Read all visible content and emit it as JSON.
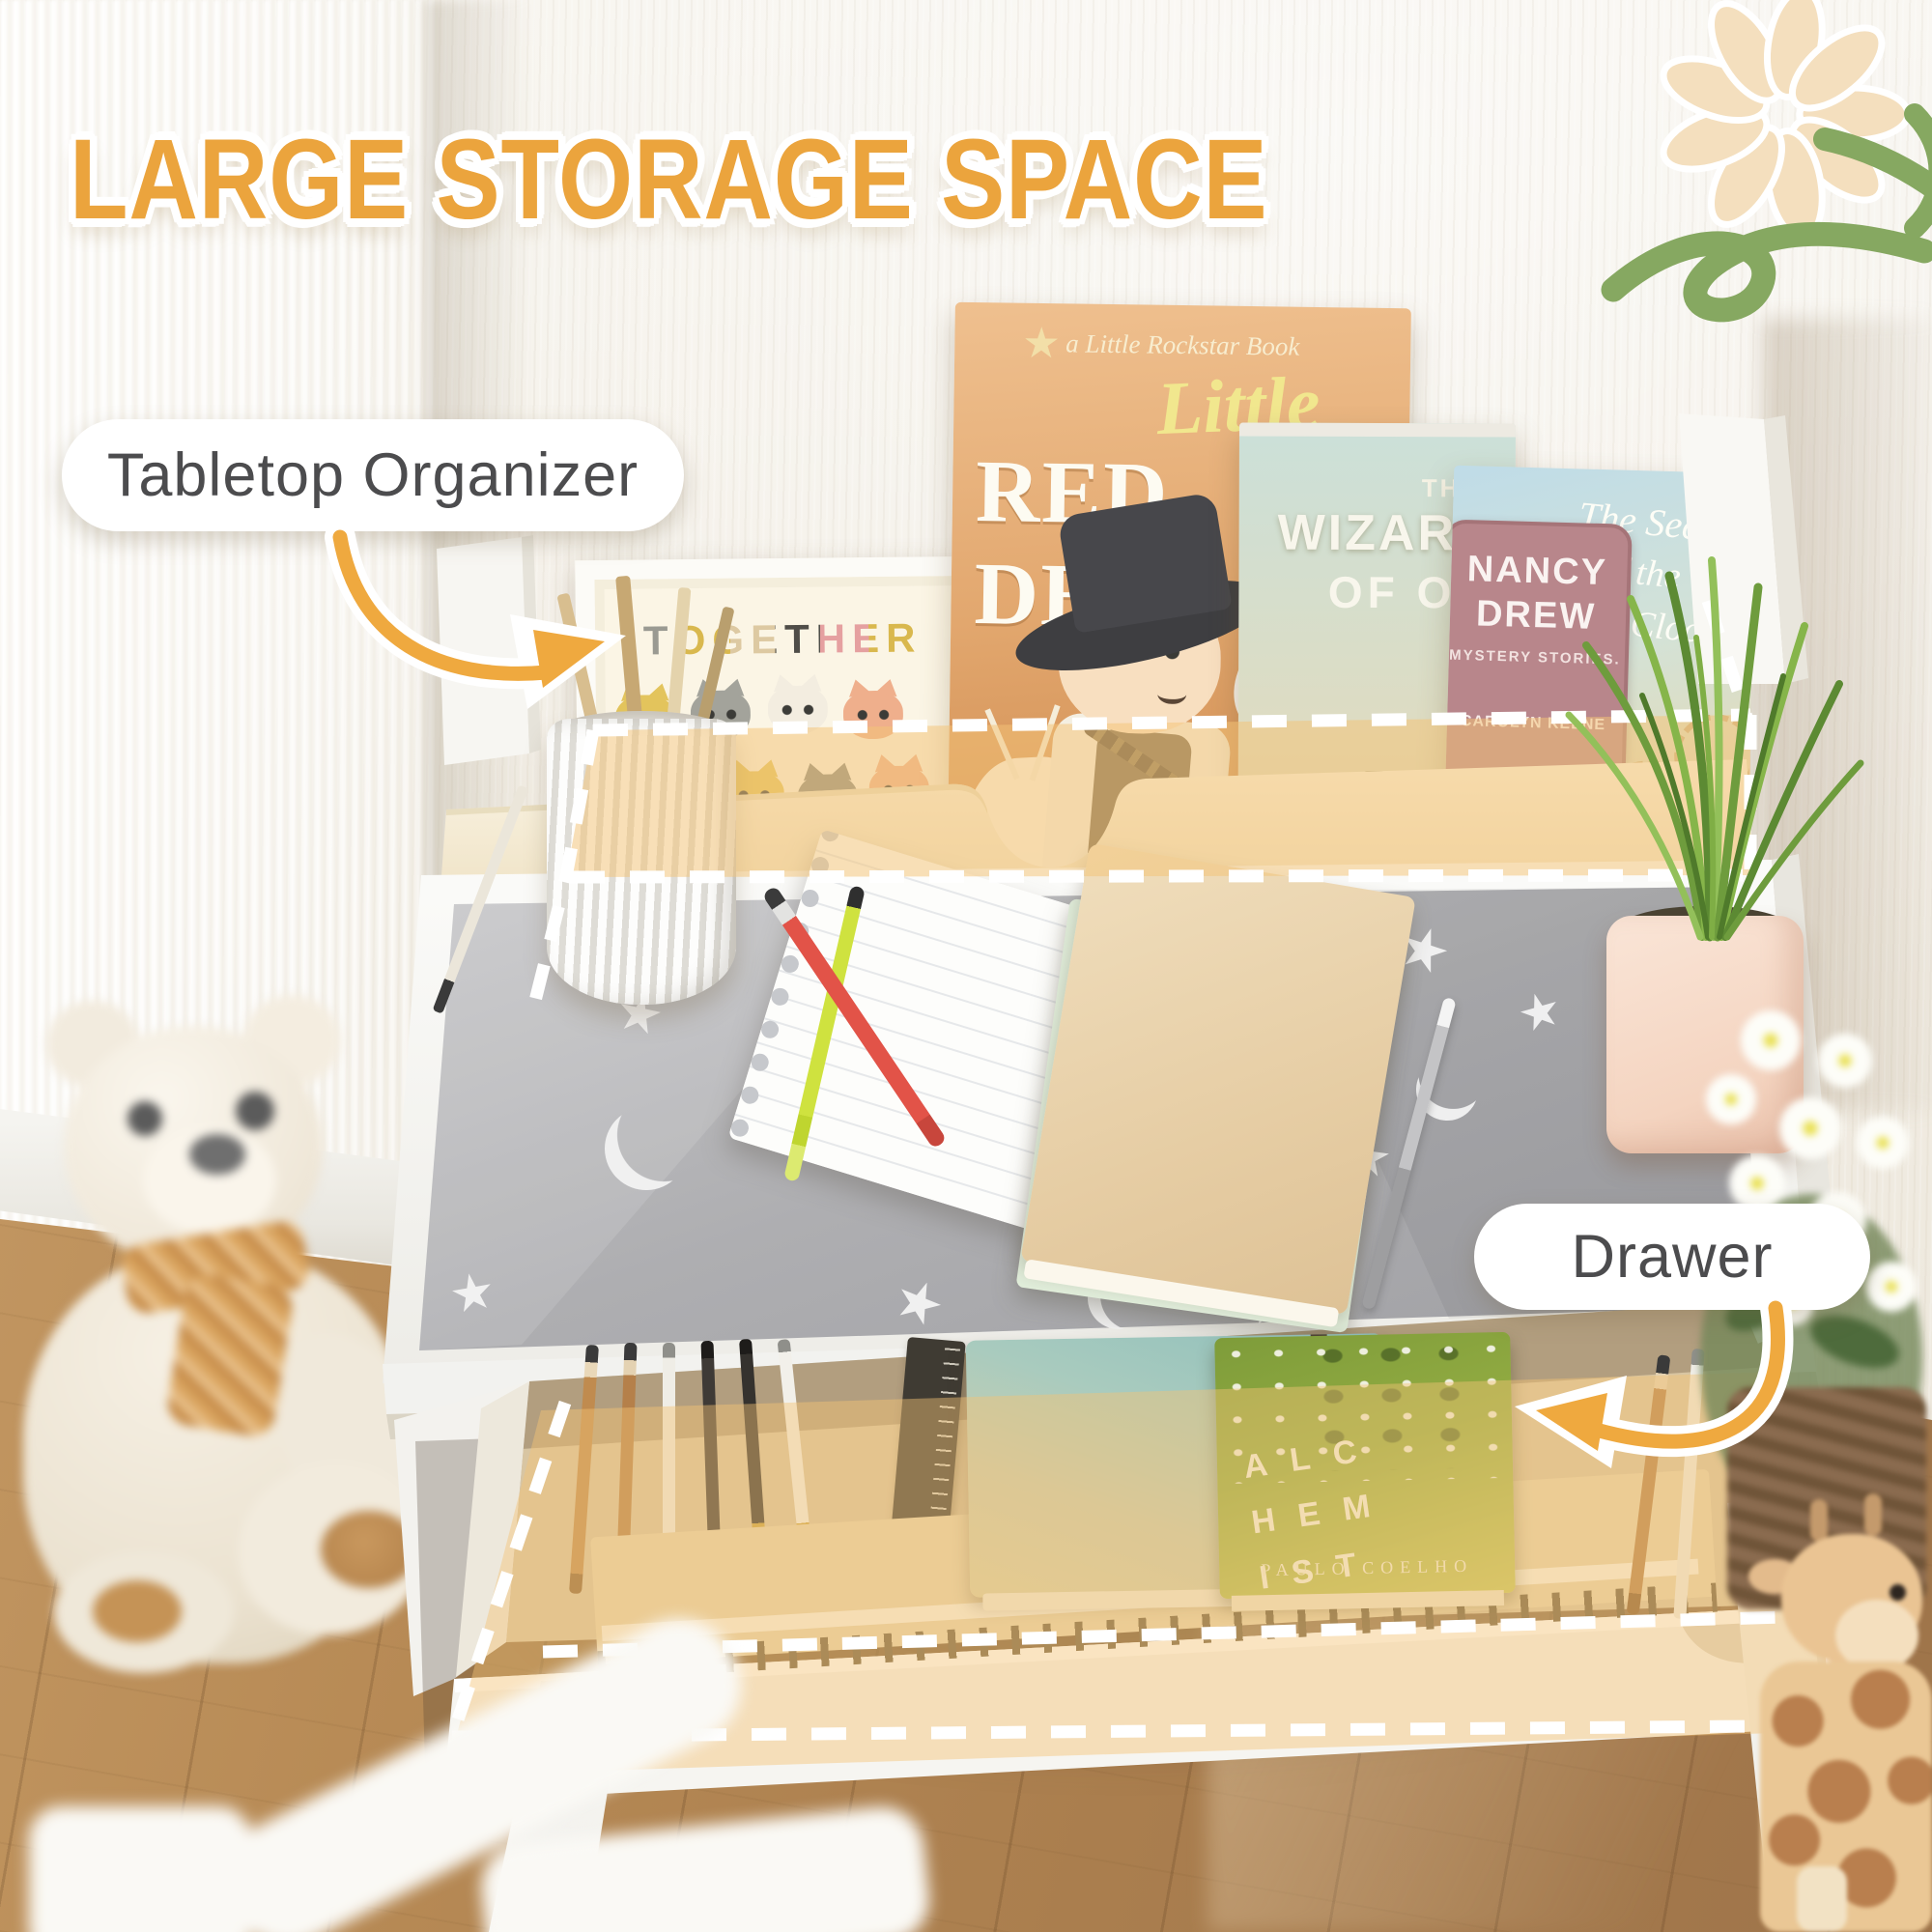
{
  "headline": "LARGE STORAGE SPACE",
  "callouts": {
    "organizer": "Tabletop Organizer",
    "drawer": "Drawer"
  },
  "books": {
    "cat_print": {
      "title": "TOGETHER"
    },
    "red_dead": {
      "imprint": "a Little Rockstar Book",
      "script": "Little",
      "title": "RED DEAD"
    },
    "wizard_oz": {
      "pre": "THE",
      "title": "WIZARD",
      "post": "OF OZ"
    },
    "nancy_drew": {
      "series_top": "NANCY",
      "series_bottom": "DREW",
      "subtitle": "MYSTERY STORIES.",
      "author": "CAROLYN KEENE",
      "title_1": "The Secret",
      "title_2": "of the Old",
      "title_3": "Clock"
    },
    "alchemist": {
      "title": "ALCHEMIST",
      "author": "PAULO COELHO"
    }
  },
  "colors": {
    "headline": "#EBA43D",
    "arrow": "#EFA93F",
    "highlight_fill": "#F3C376",
    "label_text": "#4C4C4E",
    "desk_mat": "#ADADAF",
    "drawer_interior": "#D8C5A2"
  }
}
